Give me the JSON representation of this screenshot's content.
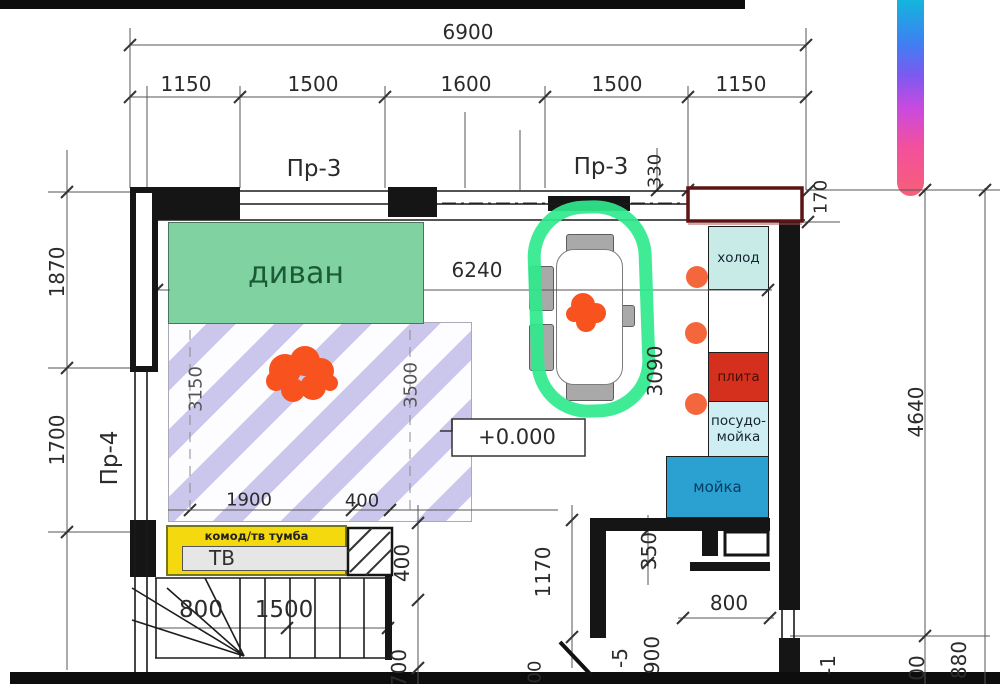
{
  "drawing": {
    "type": "apartment floor plan (living room / kitchen / stairs)",
    "level_zero": "+0.000"
  },
  "dimensions": {
    "overall_width": "6900",
    "top_row": [
      "1150",
      "1500",
      "1600",
      "1500",
      "1150"
    ],
    "opening_top_1": "Пр-3",
    "opening_top_2": "Пр-3",
    "d330": "330",
    "d170": "170",
    "d1870": "1870",
    "d1700": "1700",
    "opening_left": "Пр-4",
    "d6240": "6240",
    "d3090": "3090",
    "d3150": "3150",
    "d3500": "3500",
    "d1900": "1900",
    "d400_rug": "400",
    "d1170": "1170",
    "d350": "350",
    "d800_hall": "800",
    "level_minus5": "-5",
    "d900": "900",
    "d800_stairs": "800",
    "d1500_stairs": "1500",
    "d400_stairs": "400",
    "d700_stairs": "700",
    "d4640": "4640",
    "d880": "880",
    "partial_left": "00",
    "partial_mid": "-1",
    "partial_right": "00"
  },
  "furniture": {
    "sofa_label": "диван",
    "tv_cabinet_label": "комод/тв тумба",
    "tv_label": "ТВ"
  },
  "kitchen": {
    "fridge": "холод",
    "stove": "плита",
    "dishwasher": "посудо-мойка",
    "sink": "мойка"
  },
  "colors": {
    "sofa_green": "#80d2a1",
    "rug_stripe": "#cbc7ec",
    "marker_green": "#30e98d",
    "marker_orange": "#f8531f",
    "stove_red": "#d5301d",
    "sink_blue": "#2aa1d0",
    "fridge_cyan": "#c8ebe8",
    "dishwasher_cyan": "#cfeef4",
    "tv_yellow": "#f5d90f",
    "window_dark_red": "#5c1414",
    "gradient_bar": [
      "#12b6dc",
      "#3f80f2",
      "#c94ae0",
      "#f75f78"
    ]
  }
}
